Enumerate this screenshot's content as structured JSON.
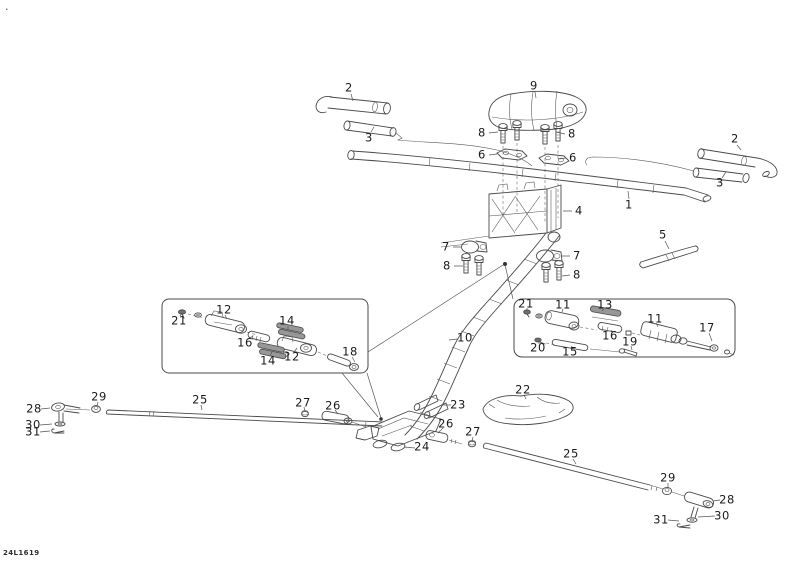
{
  "document": {
    "type": "exploded-parts-diagram",
    "subject": "Steering system exploded view",
    "drawing_code": "24L1619",
    "corner_mark": ".",
    "background_color": "#ffffff",
    "line_color": "#4a4a4a",
    "label_color": "#1b1b1b"
  },
  "part_labels": [
    {
      "part": "2",
      "x": 349,
      "y": 88
    },
    {
      "part": "3",
      "x": 369,
      "y": 138
    },
    {
      "part": "9",
      "x": 534,
      "y": 86
    },
    {
      "part": "8",
      "x": 482,
      "y": 133
    },
    {
      "part": "8",
      "x": 572,
      "y": 134
    },
    {
      "part": "6",
      "x": 482,
      "y": 155
    },
    {
      "part": "6",
      "x": 573,
      "y": 158
    },
    {
      "part": "2",
      "x": 735,
      "y": 139
    },
    {
      "part": "3",
      "x": 720,
      "y": 183
    },
    {
      "part": "1",
      "x": 629,
      "y": 205
    },
    {
      "part": "4",
      "x": 579,
      "y": 211
    },
    {
      "part": "5",
      "x": 663,
      "y": 235
    },
    {
      "part": "7",
      "x": 446,
      "y": 247
    },
    {
      "part": "7",
      "x": 577,
      "y": 256
    },
    {
      "part": "8",
      "x": 447,
      "y": 266
    },
    {
      "part": "8",
      "x": 577,
      "y": 275
    },
    {
      "part": "21",
      "x": 179,
      "y": 321
    },
    {
      "part": "12",
      "x": 224,
      "y": 310
    },
    {
      "part": "14",
      "x": 287,
      "y": 321
    },
    {
      "part": "16",
      "x": 245,
      "y": 343
    },
    {
      "part": "14",
      "x": 268,
      "y": 361
    },
    {
      "part": "12",
      "x": 292,
      "y": 357
    },
    {
      "part": "18",
      "x": 350,
      "y": 352
    },
    {
      "part": "21",
      "x": 526,
      "y": 304
    },
    {
      "part": "11",
      "x": 563,
      "y": 305
    },
    {
      "part": "13",
      "x": 605,
      "y": 305
    },
    {
      "part": "11",
      "x": 655,
      "y": 319
    },
    {
      "part": "17",
      "x": 707,
      "y": 328
    },
    {
      "part": "16",
      "x": 610,
      "y": 336
    },
    {
      "part": "20",
      "x": 538,
      "y": 348
    },
    {
      "part": "15",
      "x": 570,
      "y": 352
    },
    {
      "part": "19",
      "x": 630,
      "y": 342
    },
    {
      "part": "10",
      "x": 465,
      "y": 338
    },
    {
      "part": "22",
      "x": 523,
      "y": 390
    },
    {
      "part": "23",
      "x": 458,
      "y": 405
    },
    {
      "part": "26",
      "x": 446,
      "y": 424
    },
    {
      "part": "27",
      "x": 473,
      "y": 432
    },
    {
      "part": "24",
      "x": 422,
      "y": 447
    },
    {
      "part": "28",
      "x": 34,
      "y": 409
    },
    {
      "part": "29",
      "x": 99,
      "y": 397
    },
    {
      "part": "25",
      "x": 200,
      "y": 400
    },
    {
      "part": "27",
      "x": 303,
      "y": 403
    },
    {
      "part": "26",
      "x": 333,
      "y": 406
    },
    {
      "part": "30",
      "x": 33,
      "y": 425
    },
    {
      "part": "31",
      "x": 33,
      "y": 432
    },
    {
      "part": "25",
      "x": 571,
      "y": 454
    },
    {
      "part": "29",
      "x": 668,
      "y": 478
    },
    {
      "part": "28",
      "x": 727,
      "y": 500
    },
    {
      "part": "30",
      "x": 722,
      "y": 516
    },
    {
      "part": "31",
      "x": 661,
      "y": 520
    }
  ]
}
